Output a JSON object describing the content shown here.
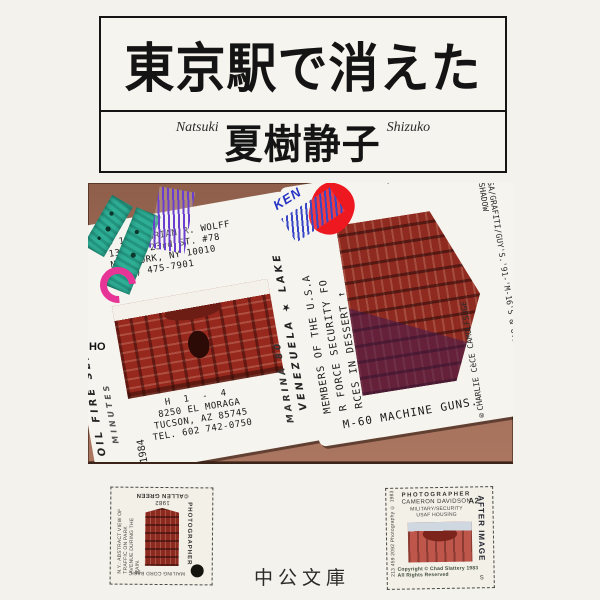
{
  "cover": {
    "title": "東京駅で消えた",
    "author_romaji_first": "Natsuki",
    "author": "夏樹静子",
    "author_romaji_last": "Shizuko",
    "publisher": "中公文庫"
  },
  "photo": {
    "edge_scribble": "HO",
    "ken_stamp": "KEN",
    "left_card": {
      "address_lines": [
        "© 1987 BRIAN R. WOLFF",
        "131 E. 23rd ST. #78",
        "NEW YORK, NY 10010",
        "(212) 475-7901"
      ],
      "bottom_lines": [
        "H 1 - 4",
        "8250 EL MORAGA",
        "TUCSON, AZ 85745",
        "TEL. 602 742-0750"
      ],
      "year_label": "1984",
      "handwritten_left_1": "OIL FIRE SEA OY",
      "handwritten_left_2": "MINUTES",
      "handwritten_right_1": "VENEZUELA ★ LAKE",
      "handwritten_right_2": "MARINA 80"
    },
    "right_card": {
      "top_reversed_text": "-CHEMICAL WAR TRA",
      "column_1": "MEMBERS OF THE U.S.A",
      "column_2": "R FORCE SECURITY FO",
      "column_3": "RCES IN DESSERT ↑",
      "bottom_line": "M-60 MACHINE GUNS.",
      "credit_column": "®CHARLIE CèCE CAMOLFSUGE",
      "side_column": "SA/GRAFITI/GUY'S.'91-'M-16'S & U.S. FLAG/WITH SHADOW"
    }
  },
  "stamps": {
    "left": {
      "year": "1982",
      "copyright": "©ALLEN GREEN",
      "photographer": "PHOTOGRAPHER",
      "caption": "N.Y.: ABSTRACT VIEW OF TRAFFIC ON PARK AVENUE DURING THE RAIN.",
      "bottom_text": "MAILING CORD BASIC",
      "code": "18"
    },
    "right": {
      "photographer": "PHOTOGRAPHER",
      "name": "CAMERON DAVIDSON",
      "subject": "MILITARY/SECURITY",
      "code": "A2",
      "subject2": "USAF HOUSING",
      "copyright_1": "Copyright © Chad Slattery 1983",
      "copyright_2": "All Rights Reserved",
      "side_right": "AFTER IMAGE",
      "side_left": "213 459 2092 Photography © 1983",
      "bottom_code": "S"
    }
  }
}
